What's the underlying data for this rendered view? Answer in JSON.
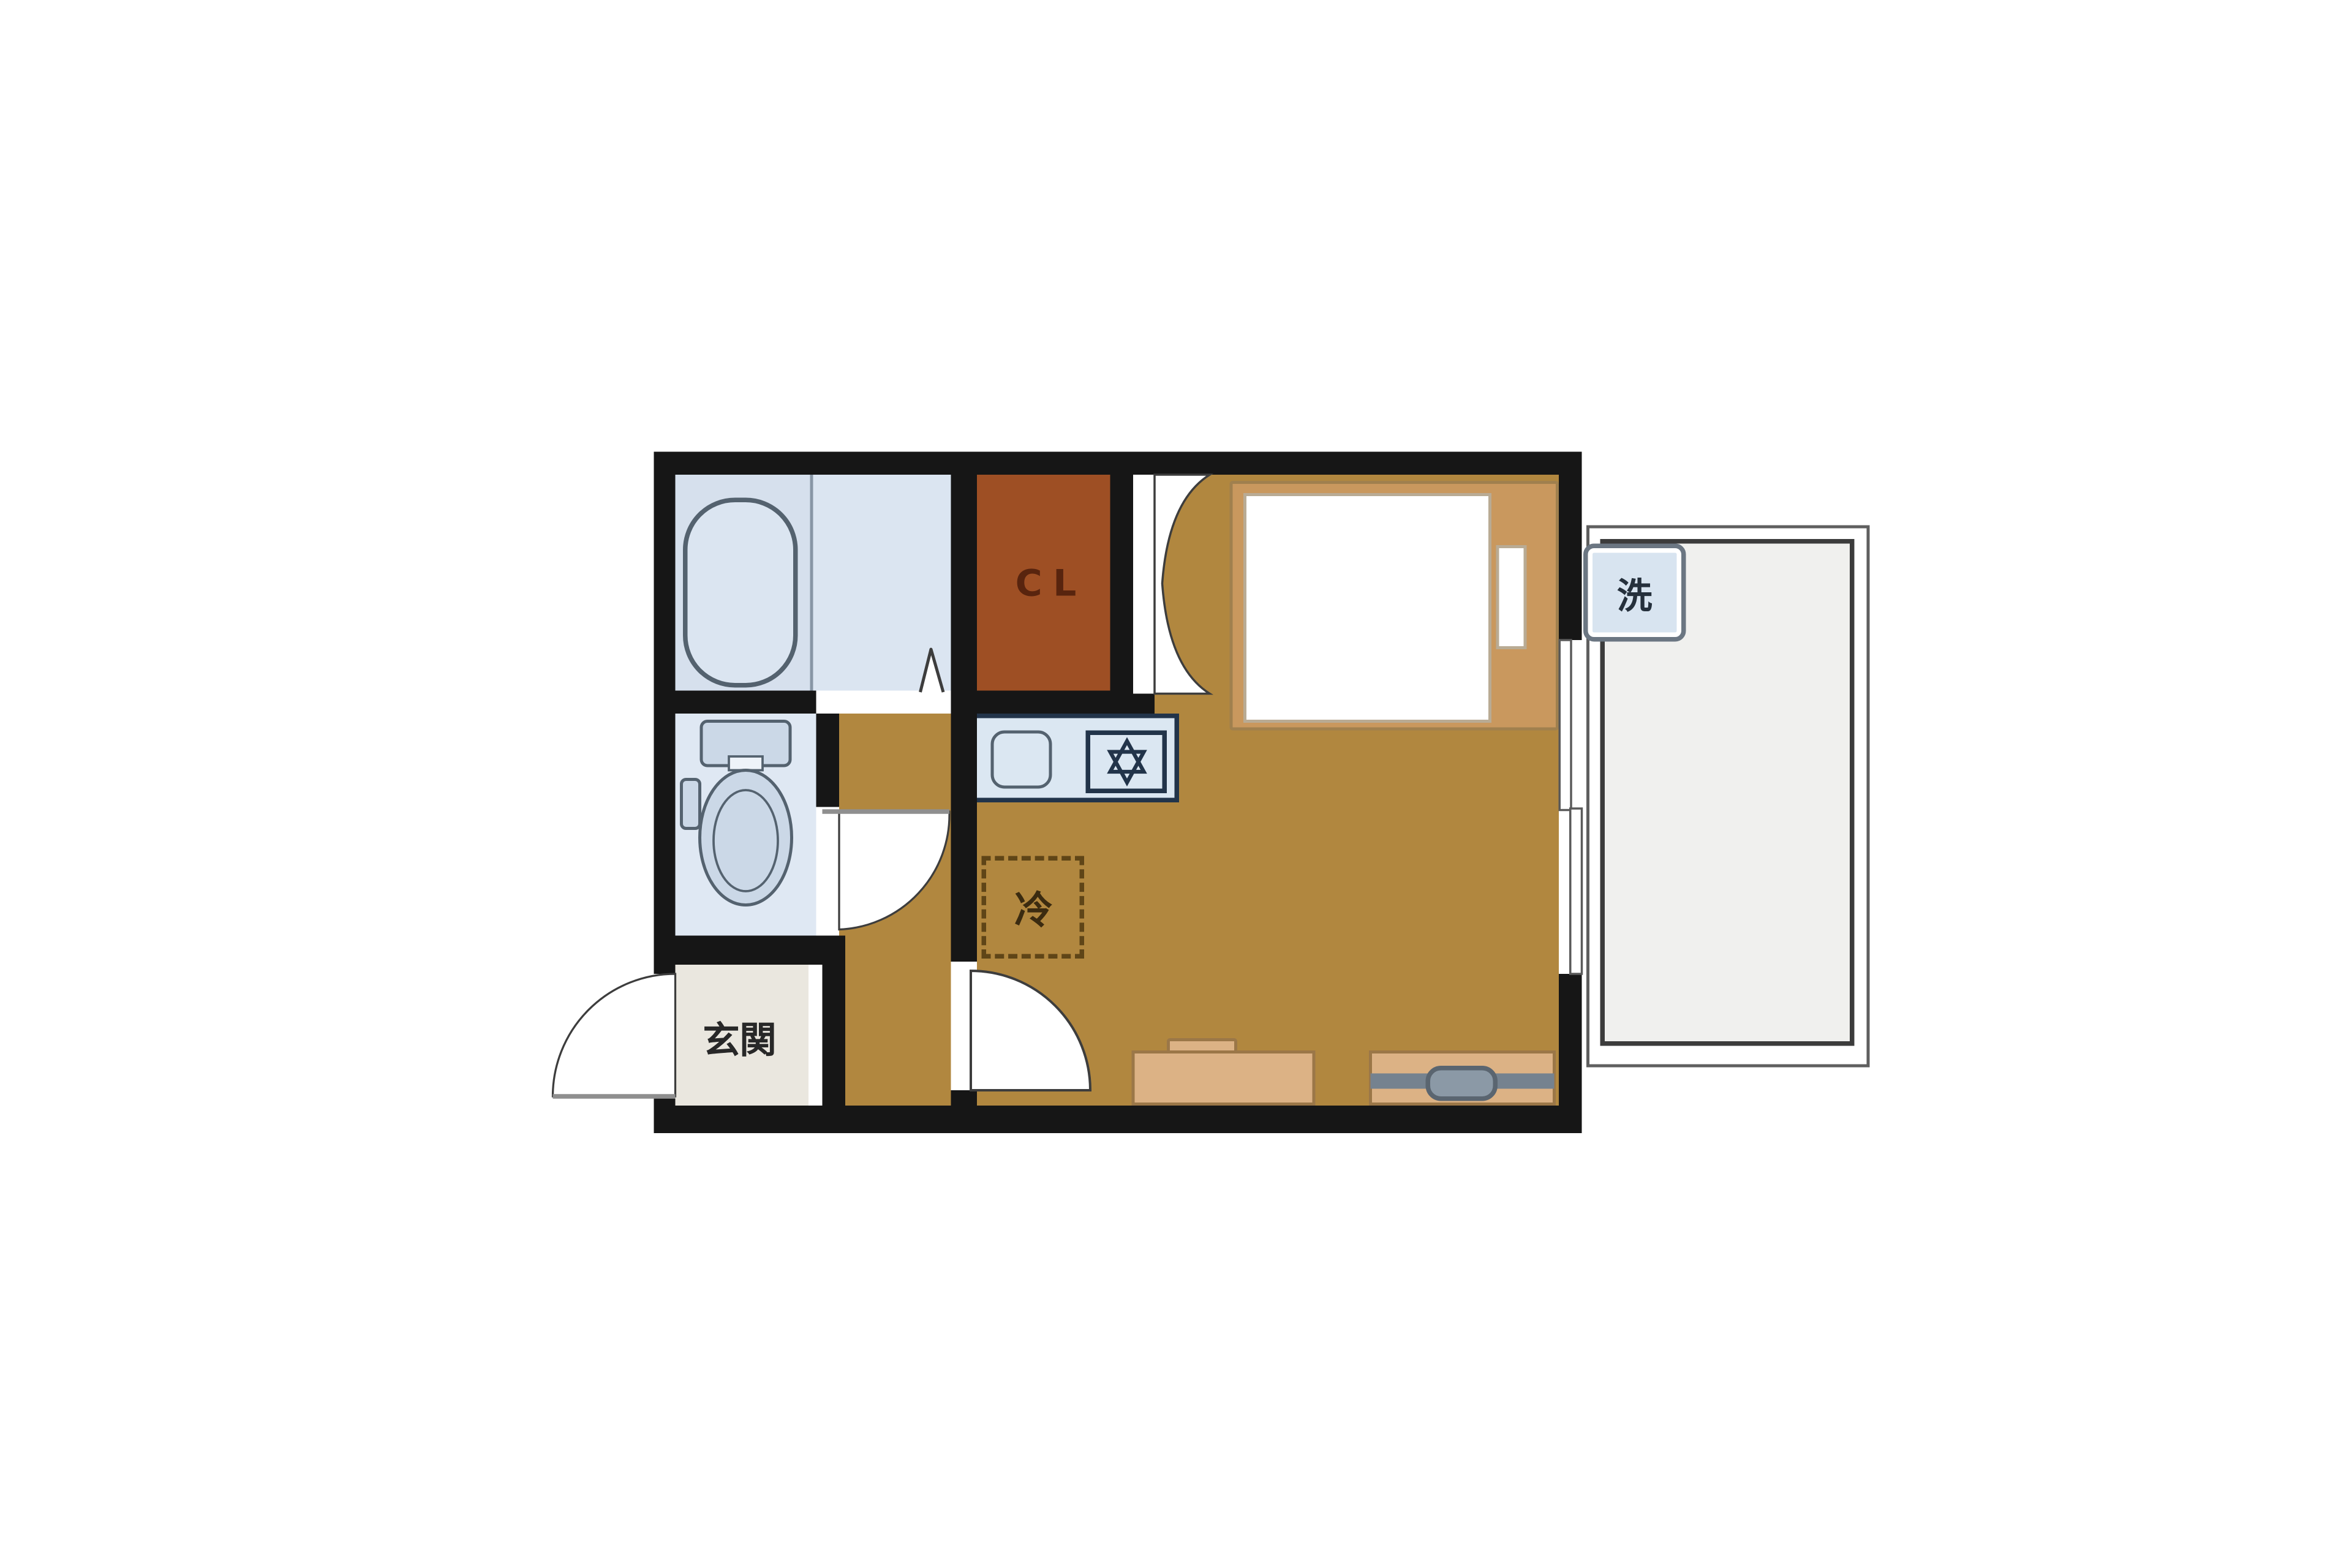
{
  "floorplan": {
    "type": "japanese-1K-apartment-floorplan",
    "labels": {
      "closet": "CL",
      "entrance": "玄関",
      "refrigerator": "冷",
      "washing_machine": "洗"
    },
    "icons": {
      "bathtub-icon": "rounded stadium outline (tub seen from above)",
      "toilet-icon": "tank + oval bowl seen from above",
      "sink-icon": "rounded square basin",
      "stove-icon": "square with six-pointed star burner ✡",
      "tv-icon": "rounded TV on board with gray rail",
      "door-arc-icon": "quarter-circle swing arc",
      "double-door-icon": "butterfly double swing arcs",
      "folding-door-icon": "peaked fold mark ∧",
      "sliding-window-icon": "two offset white panels in wall"
    },
    "colors": {
      "page_bg": "#ffffff",
      "wall": "#161616",
      "floor": "#b1873f",
      "closet": "#9e4f24",
      "closet_text": "#58240e",
      "bathroom_left": "#d6e0ed",
      "bathroom_right": "#dbe5f1",
      "toilet_room": "#dfe8f3",
      "fixture_fill": "#cbd8e7",
      "fixture_stroke": "#54626f",
      "entrance": "#eae7df",
      "entrance_text": "#282828",
      "kitchen_fill": "#dbe7f2",
      "kitchen_border": "#22344a",
      "fridge_dash": "#5f4517",
      "fridge_text": "#3b2b10",
      "bed_frame": "#c9985e",
      "bed_frame_border": "#a0804e",
      "mattress": "#ffffff",
      "mattress_stroke": "#b9ab94",
      "furniture": "#dcb285",
      "furniture_border": "#9b7748",
      "tv_band": "#75828f",
      "tv_fill": "#8b99a6",
      "tv_stroke": "#5a6570",
      "balcony_fill": "#f0f0ee",
      "balcony_inner_border": "#3c3c3c",
      "balcony_outer_border": "#5f5f5f",
      "washer_fill": "#d8e4f0",
      "washer_border": "#6b7682",
      "washer_text": "#25303c",
      "door_arc": "#3d3d3d",
      "door_leaf": "#8f8f8f",
      "window_stroke": "#5a5a5a",
      "divider_line": "#8896a6",
      "white": "#ffffff",
      "tank_notch": "#eef3f9"
    }
  }
}
